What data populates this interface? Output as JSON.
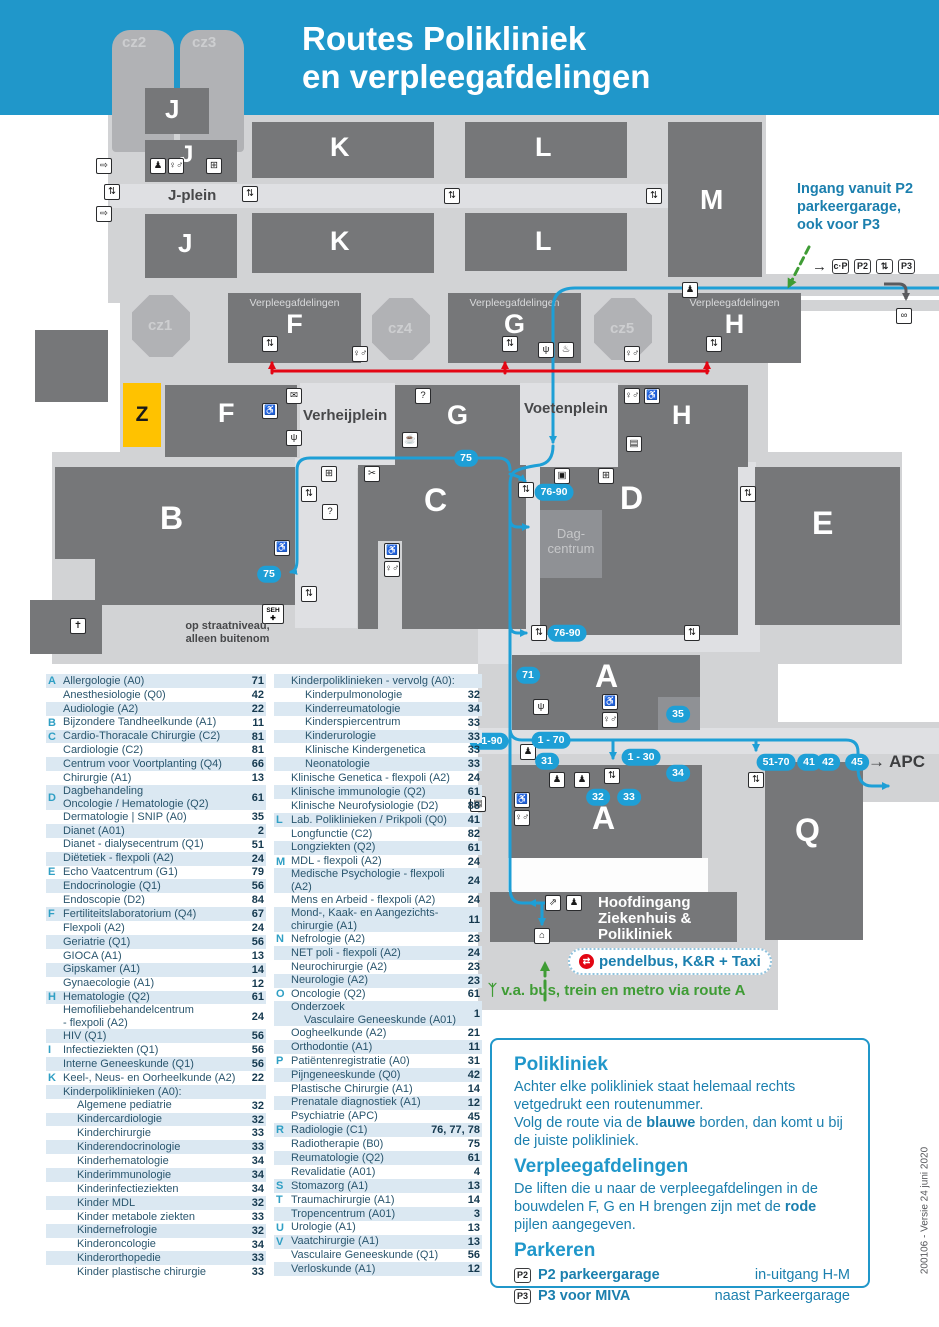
{
  "title": {
    "line1": "Routes Polikliniek",
    "line2": "en verpleegafdelingen"
  },
  "map": {
    "buildings": {
      "cz1": "cz1",
      "cz2": "cz2",
      "cz3": "cz3",
      "cz4": "cz4",
      "cz5": "cz5",
      "j1": "J",
      "j2": "J",
      "j3": "J",
      "k1": "K",
      "k2": "K",
      "l1": "L",
      "l2": "L",
      "m": "M",
      "ward_title": "Verpleegafdelingen",
      "ward_f": "F",
      "ward_g": "G",
      "ward_h": "H",
      "z": "Z",
      "f": "F",
      "g": "G",
      "h": "H",
      "b": "B",
      "c": "C",
      "d": "D",
      "e": "E",
      "a_upper": "A",
      "a_lower": "A",
      "q": "Q",
      "dagcentrum_line1": "Dag-",
      "dagcentrum_line2": "centrum"
    },
    "place_labels": {
      "j_plein": "J-plein",
      "verheijplein": "Verheijplein",
      "voetenplein": "Voetenplein",
      "street_note1": "op straatniveau,",
      "street_note2": "alleen buitenom",
      "hoofdingang": [
        "Hoofdingang",
        "Ziekenhuis &",
        "Polikliniek"
      ],
      "apc_arrow": "→",
      "apc": "APC"
    },
    "ingang_note": [
      "Ingang vanuit P2",
      "parkeergarage,",
      "ook voor P3"
    ],
    "parking_row": {
      "arrow": "→",
      "cp": "c·P",
      "p2": "P2",
      "lift": "⇅",
      "p3": "P3"
    },
    "bubbles": {
      "r75_top": "75",
      "r75_b": "75",
      "r7690_mid": "76-90",
      "r7690_bottom": "76-90",
      "r71": "71",
      "r35": "35",
      "r7190": "71-90",
      "r170": "1 - 70",
      "r31": "31",
      "r130": "1 - 30",
      "r32": "32",
      "r33": "33",
      "r34": "34",
      "r5170": "51-70",
      "r41": "41",
      "r42": "42",
      "r45": "45"
    },
    "icons": {
      "elevator": "⇅",
      "toilets": "♀♂",
      "wheelchair": "♿",
      "reception": "♟",
      "person": "♟",
      "info": "?",
      "shop": "⊞",
      "coffee": "☕",
      "restaurant": "ψ",
      "mail": "✉",
      "scissors": "✂",
      "church": "✝",
      "screen": "▤",
      "escalator": "⇗",
      "exit": "⇨",
      "door": "⌂",
      "bed": "▤",
      "atm": "▣",
      "bicycle": "∞",
      "bell": "♨",
      "seh_label": "SEH",
      "seh_cross": "✚",
      "pendelbus_glyph": "⇄",
      "walking": "ᛉ",
      "gray_arrow": "↓"
    },
    "pendelbus": "pendelbus, K&R + Taxi",
    "bus_note": "v.a. bus, trein en metro via route A"
  },
  "directory": {
    "columns": [
      {
        "items": [
          {
            "letter": "A",
            "name": "Allergologie (A0)",
            "route": "71"
          },
          {
            "name": "Anesthesiologie (Q0)",
            "route": "42"
          },
          {
            "name": "Audiologie (A2)",
            "route": "22"
          },
          {
            "letter": "B",
            "name": "Bijzondere Tandheelkunde (A1)",
            "route": "11"
          },
          {
            "letter": "C",
            "name": "Cardio-Thoracale Chirurgie (C2)",
            "route": "81"
          },
          {
            "name": "Cardiologie (C2)",
            "route": "81"
          },
          {
            "name": "Centrum voor Voortplanting (Q4)",
            "route": "66"
          },
          {
            "name": "Chirurgie (A1)",
            "route": "13"
          },
          {
            "letter": "D",
            "name": "Dagbehandeling",
            "name2": "Oncologie / Hematologie (Q2)",
            "route": "61"
          },
          {
            "name": "Dermatologie | SNIP (A0)",
            "route": "35"
          },
          {
            "name": "Dianet (A01)",
            "route": "2"
          },
          {
            "name": "Dianet - dialysecentrum (Q1)",
            "route": "51"
          },
          {
            "name": "Diëtetiek - flexpoli (A2)",
            "route": "24"
          },
          {
            "letter": "E",
            "name": "Echo Vaatcentrum (G1)",
            "route": "79"
          },
          {
            "name": "Endocrinologie (Q1)",
            "route": "56"
          },
          {
            "name": "Endoscopie (D2)",
            "route": "84"
          },
          {
            "letter": "F",
            "name": "Fertiliteitslaboratorium (Q4)",
            "route": "67"
          },
          {
            "name": "Flexpoli (A2)",
            "route": "24"
          },
          {
            "name": "Geriatrie (Q1)",
            "route": "56"
          },
          {
            "name": "GIOCA (A1)",
            "route": "13"
          },
          {
            "name": "Gipskamer (A1)",
            "route": "14"
          },
          {
            "name": "Gynaecologie (A1)",
            "route": "12"
          },
          {
            "letter": "H",
            "name": "Hematologie (Q2)",
            "route": "61"
          },
          {
            "name": "Hemofiliebehandelcentrum",
            "name2": "- flexpoli (A2)",
            "route": "24"
          },
          {
            "name": "HIV (Q1)",
            "route": "56"
          },
          {
            "letter": "I",
            "name": "Infectieziekten (Q1)",
            "route": "56"
          },
          {
            "name": "Interne Geneeskunde (Q1)",
            "route": "56"
          },
          {
            "letter": "K",
            "name": "Keel-, Neus- en Oorheelkunde (A2)",
            "route": "22"
          },
          {
            "name": "Kinderpoliklinieken (A0):"
          },
          {
            "name": "Algemene pediatrie",
            "route": "32",
            "indent": true
          },
          {
            "name": "Kindercardiologie",
            "route": "32",
            "indent": true
          },
          {
            "name": "Kinderchirurgie",
            "route": "33",
            "indent": true
          },
          {
            "name": "Kinderendocrinologie",
            "route": "33",
            "indent": true
          },
          {
            "name": "Kinderhematologie",
            "route": "34",
            "indent": true
          },
          {
            "name": "Kinderimmunologie",
            "route": "34",
            "indent": true
          },
          {
            "name": "Kinderinfectieziekten",
            "route": "34",
            "indent": true
          },
          {
            "name": "Kinder MDL",
            "route": "32",
            "indent": true
          },
          {
            "name": "Kinder metabole ziekten",
            "route": "33",
            "indent": true
          },
          {
            "name": "Kindernefrologie",
            "route": "32",
            "indent": true
          },
          {
            "name": "Kinderoncologie",
            "route": "34",
            "indent": true
          },
          {
            "name": "Kinderorthopedie",
            "route": "33",
            "indent": true
          },
          {
            "name": "Kinder plastische chirurgie",
            "route": "33",
            "indent": true
          }
        ]
      },
      {
        "items": [
          {
            "name": "Kinderpoliklinieken - vervolg (A0):"
          },
          {
            "name": "Kinderpulmonologie",
            "route": "32",
            "indent": true
          },
          {
            "name": "Kinderreumatologie",
            "route": "34",
            "indent": true
          },
          {
            "name": "Kinderspiercentrum",
            "route": "33",
            "indent": true
          },
          {
            "name": "Kinderurologie",
            "route": "33",
            "indent": true
          },
          {
            "name": "Klinische Kindergenetica",
            "route": "33",
            "indent": true
          },
          {
            "name": "Neonatologie",
            "route": "33",
            "indent": true
          },
          {
            "name": "Klinische Genetica - flexpoli (A2)",
            "route": "24"
          },
          {
            "name": "Klinische immunologie (Q2)",
            "route": "61"
          },
          {
            "name": "Klinische Neurofysiologie (D2)",
            "route": "88"
          },
          {
            "letter": "L",
            "name": "Lab. Poliklinieken / Prikpoli (Q0)",
            "route": "41"
          },
          {
            "name": "Longfunctie (C2)",
            "route": "82"
          },
          {
            "name": "Longziekten (Q2)",
            "route": "61"
          },
          {
            "letter": "M",
            "name": "MDL - flexpoli (A2)",
            "route": "24"
          },
          {
            "name": "Medische Psychologie - flexpoli (A2)",
            "route": "24"
          },
          {
            "name": "Mens en Arbeid - flexpoli (A2)",
            "route": "24"
          },
          {
            "name": "Mond-, Kaak- en Aangezichts-",
            "name2": "chirurgie (A1)",
            "route": "11"
          },
          {
            "letter": "N",
            "name": "Nefrologie (A2)",
            "route": "23"
          },
          {
            "name": "NET poli - flexpoli (A2)",
            "route": "24"
          },
          {
            "name": "Neurochirurgie (A2)",
            "route": "23"
          },
          {
            "name": "Neurologie (A2)",
            "route": "23"
          },
          {
            "letter": "O",
            "name": "Oncologie (Q2)",
            "route": "61"
          },
          {
            "name": "Onderzoek",
            "name2": "Vasculaire Geneeskunde (A01)",
            "route": "1",
            "indent2": true
          },
          {
            "name": "Oogheelkunde (A2)",
            "route": "21"
          },
          {
            "name": "Orthodontie (A1)",
            "route": "11"
          },
          {
            "letter": "P",
            "name": "Patiëntenregistratie (A0)",
            "route": "31"
          },
          {
            "name": "Pijngeneeskunde (Q0)",
            "route": "42"
          },
          {
            "name": "Plastische Chirurgie (A1)",
            "route": "14"
          },
          {
            "name": "Prenatale diagnostiek (A1)",
            "route": "12"
          },
          {
            "name": "Psychiatrie (APC)",
            "route": "45"
          },
          {
            "letter": "R",
            "name": "Radiologie (C1)",
            "route": "76, 77, 78"
          },
          {
            "name": "Radiotherapie (B0)",
            "route": "75"
          },
          {
            "name": "Reumatologie (Q2)",
            "route": "61"
          },
          {
            "name": "Revalidatie (A01)",
            "route": "4"
          },
          {
            "letter": "S",
            "name": "Stomazorg (A1)",
            "route": "13"
          },
          {
            "letter": "T",
            "name": "Traumachirurgie (A1)",
            "route": "14"
          },
          {
            "name": "Tropencentrum (A01)",
            "route": "3"
          },
          {
            "letter": "U",
            "name": "Urologie (A1)",
            "route": "13"
          },
          {
            "letter": "V",
            "name": "Vaatchirurgie (A1)",
            "route": "13"
          },
          {
            "name": "Vasculaire Geneeskunde (Q1)",
            "route": "56"
          },
          {
            "name": "Verloskunde (A1)",
            "route": "12"
          }
        ]
      }
    ]
  },
  "legend": {
    "polikliniek_title": "Polikliniek",
    "polikliniek_p1": "Achter elke polikliniek staat helemaal rechts vetgedrukt een routenummer.",
    "polikliniek_p2_pre": "Volg de route via de ",
    "polikliniek_p2_bold": "blauwe",
    "polikliniek_p2_post": " borden, dan komt u bij de juiste polikliniek.",
    "verpleeg_title": "Verpleegafdelingen",
    "verpleeg_p_pre": "De liften die u naar de verpleegafdelingen in de bouwdelen F, G en H brengen zijn met de ",
    "verpleeg_p_bold": "rode",
    "verpleeg_p_post": " pijlen aangegeven.",
    "parkeren_title": "Parkeren",
    "p2_icon": "P2",
    "p2_label": "P2 parkeergarage",
    "p2_right": "in-uitgang H-M",
    "p3_icon": "P3",
    "p3_label": "P3 voor MIVA",
    "p3_right": "naast Parkeergarage"
  },
  "version": "200106 - Versie 24 juni 2020",
  "colors": {
    "header_blue": "#2097ca",
    "route_blue": "#1e9fd6",
    "route_red": "#e30613",
    "route_green": "#3f9c35",
    "building_gray": "#767779",
    "ground_gray": "#d2d3d5",
    "z_yellow": "#ffc200"
  }
}
